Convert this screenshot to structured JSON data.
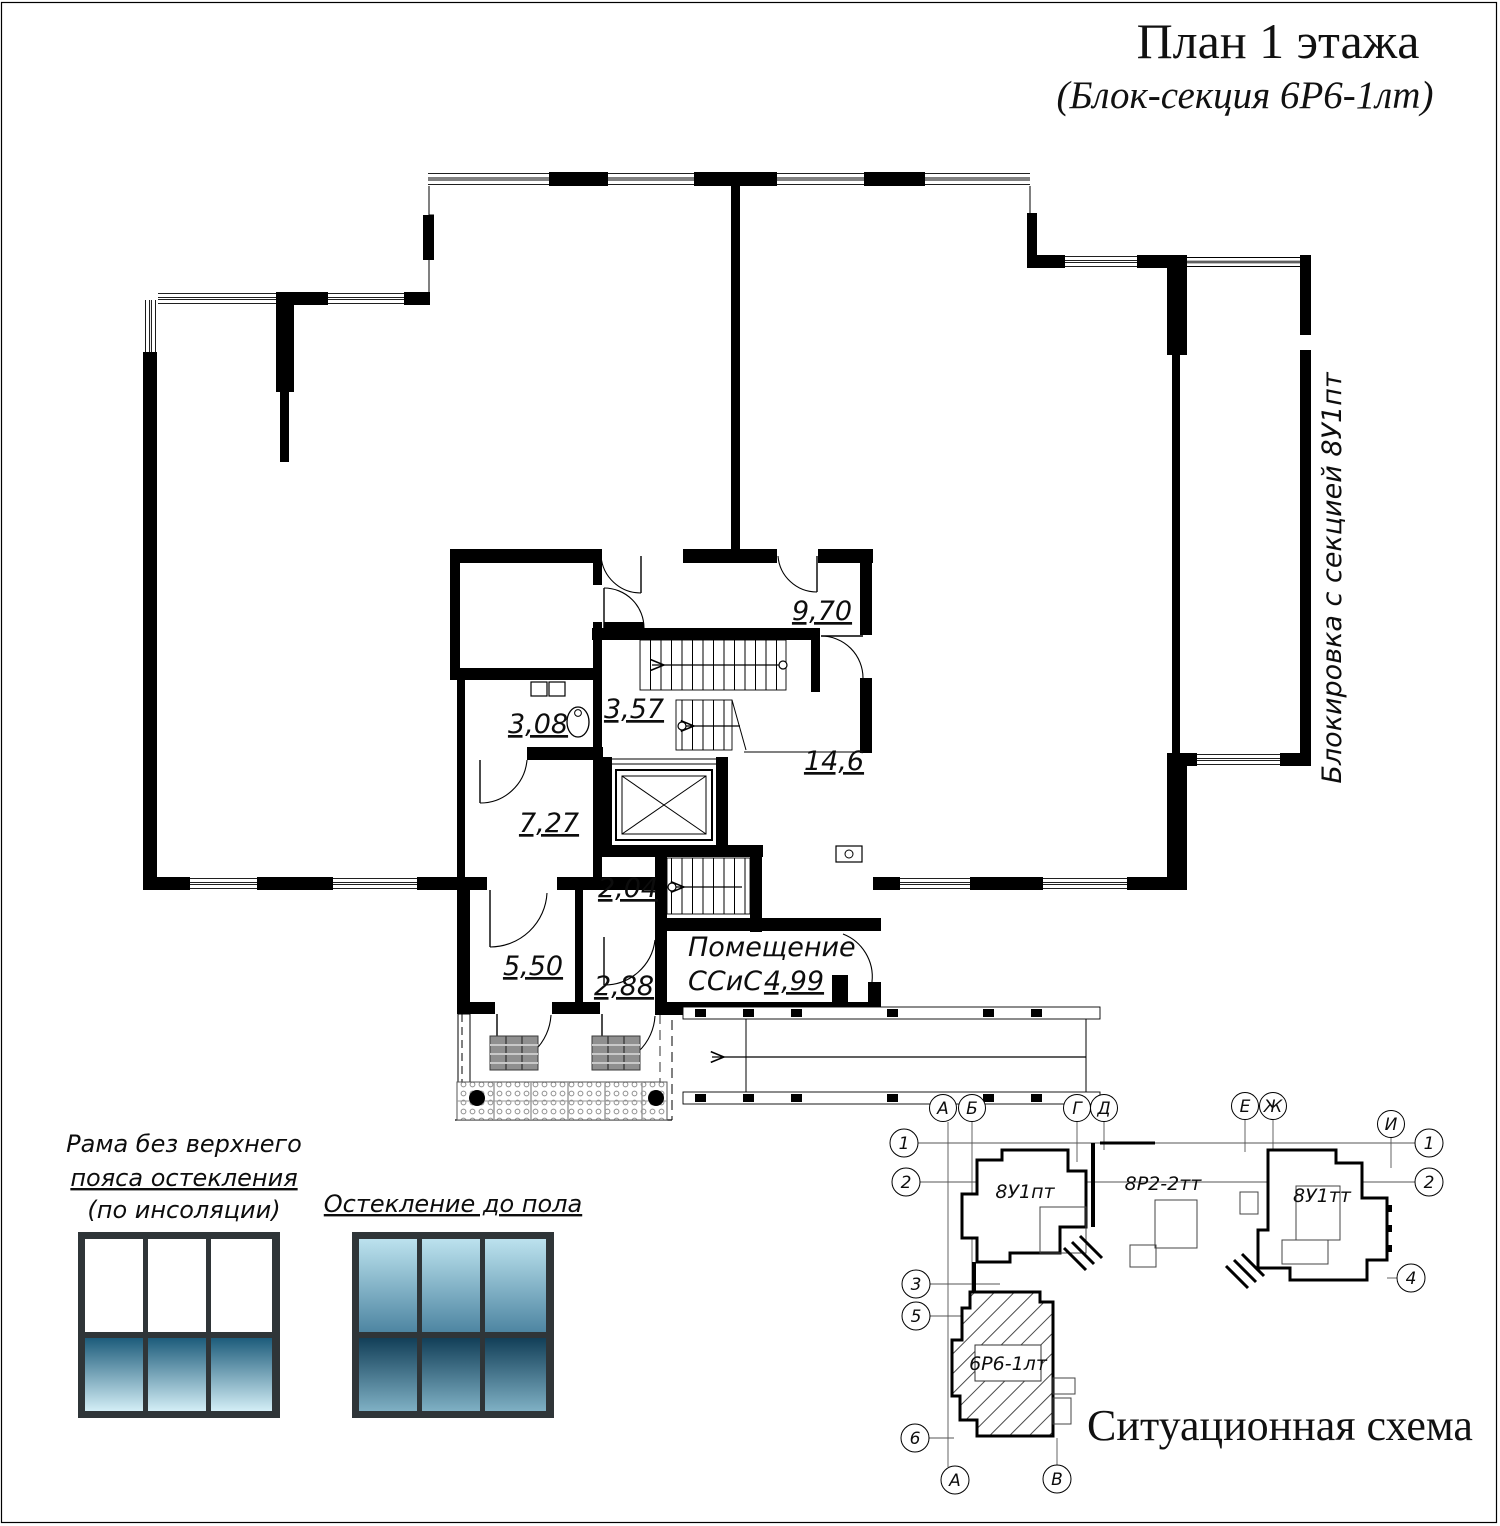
{
  "title": {
    "main": "План 1 этажа",
    "sub": "(Блок-секция 6Р6-1лт)"
  },
  "side_note": "Блокировка с секцией 8У1пт",
  "rooms": {
    "corridor": "9,70",
    "stairs": "3,57",
    "wc": "3,08",
    "hall_right": "14,6",
    "hall_left": "7,27",
    "lobby": "2,04",
    "vestibule1": "5,50",
    "vestibule2": "2,88",
    "sscs_name": "Помещение",
    "sscs_abbr": "ССиС",
    "sscs_area": "4,99"
  },
  "legend": {
    "item1_line1": "Рама без верхнего",
    "item1_line2": "пояса остекления",
    "item1_line3": "(по инсоляции)",
    "item2": "Остекление до пола"
  },
  "scheme": {
    "caption": "Ситуационная схема",
    "block1": "8У1пт",
    "block2": "8Р2-2тт",
    "block3": "8У1тт",
    "block4": "6Р6-1лт",
    "axes": {
      "a": "А",
      "b": "Б",
      "g": "Г",
      "d": "Д",
      "e": "Е",
      "zh": "Ж",
      "i": "И",
      "v": "В",
      "n1": "1",
      "n2": "2",
      "n3": "3",
      "n4": "4",
      "n5": "5",
      "n6": "6"
    }
  },
  "colors": {
    "wall": "#000000",
    "frame": "#2f3538",
    "glass_a_top": "#1d5c7b",
    "glass_a_bottom": "#d3eef6",
    "glass_b_top": "#bce2ee",
    "glass_b_bottom": "#4e86a2",
    "glass_c_top": "#123f58",
    "glass_c_bottom": "#7fb0c4"
  }
}
